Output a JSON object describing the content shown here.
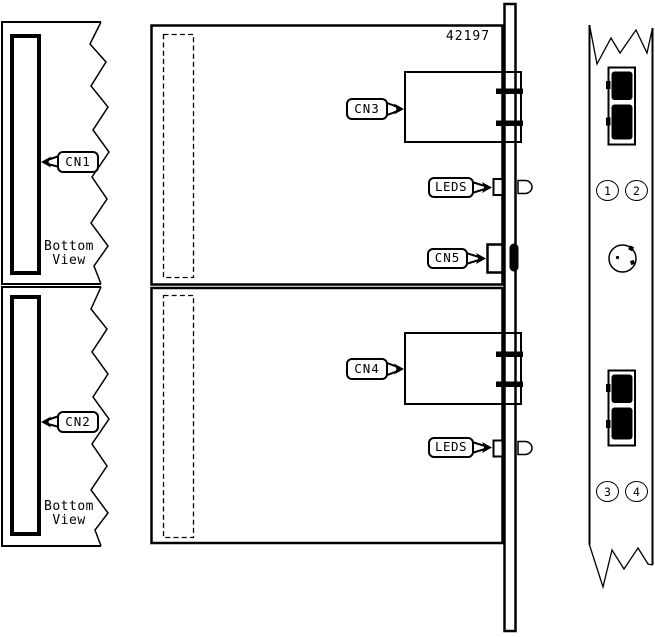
{
  "diagram": {
    "part_number": "42197",
    "callouts": {
      "cn1": "CN1",
      "cn2": "CN2",
      "cn3": "CN3",
      "cn4": "CN4",
      "cn5": "CN5",
      "leds_upper": "LEDS",
      "leds_lower": "LEDS"
    },
    "captions": {
      "upper": {
        "line1": "Bottom",
        "line2": "View"
      },
      "lower": {
        "line1": "Bottom",
        "line2": "View"
      }
    },
    "faceplate": {
      "ports": {
        "p1": "1",
        "p2": "2",
        "p3": "3",
        "p4": "4"
      }
    },
    "colors": {
      "line": "#000000",
      "background": "#ffffff"
    }
  }
}
